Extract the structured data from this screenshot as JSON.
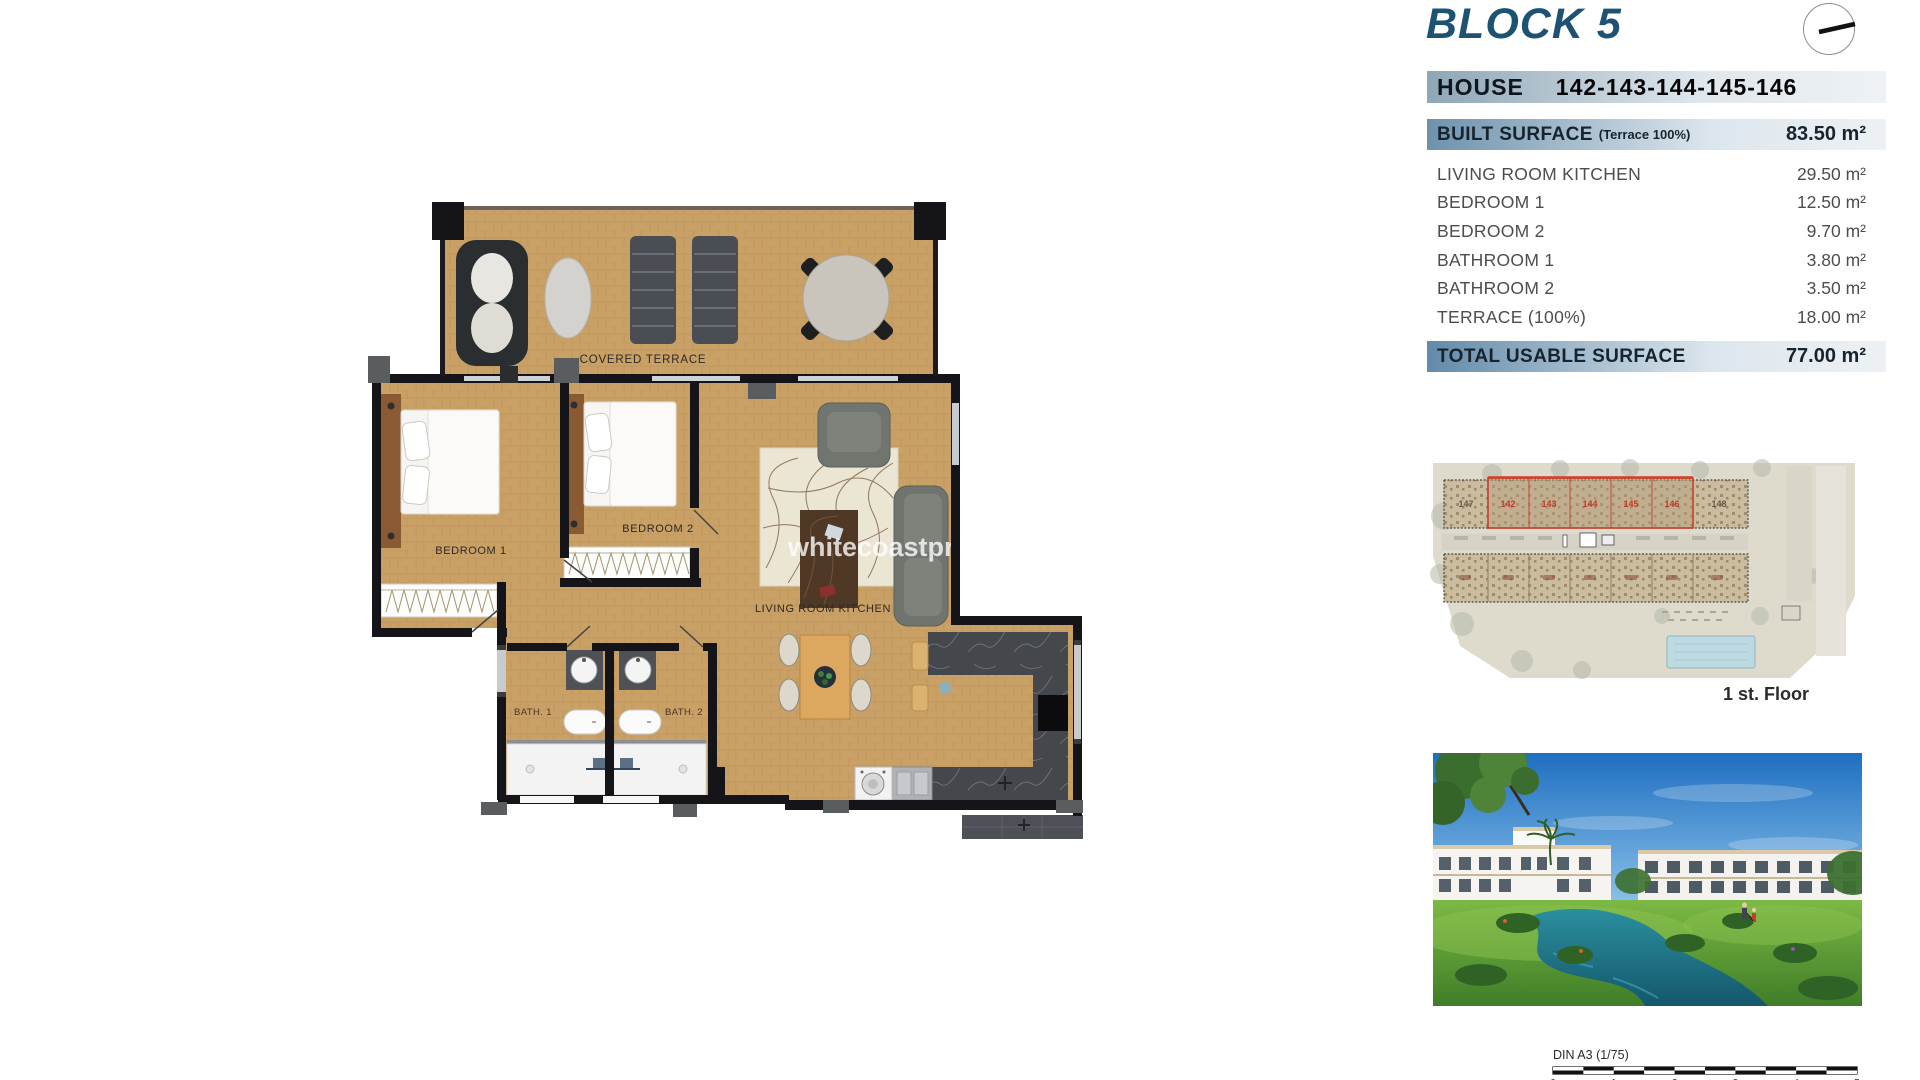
{
  "header": {
    "block_title": "BLOCK 5",
    "house_label": "HOUSE",
    "house_numbers": "142-143-144-145-146"
  },
  "surface_table": {
    "built_label": "BUILT SURFACE",
    "built_note": "(Terrace 100%)",
    "built_value": "83.50 m²",
    "rows": [
      {
        "label": "LIVING ROOM KITCHEN",
        "value": "29.50 m²"
      },
      {
        "label": "BEDROOM 1",
        "value": "12.50 m²"
      },
      {
        "label": "BEDROOM 2",
        "value": "9.70 m²"
      },
      {
        "label": "BATHROOM 1",
        "value": "3.80 m²"
      },
      {
        "label": "BATHROOM 2",
        "value": "3.50 m²"
      },
      {
        "label": "TERRACE (100%)",
        "value": "18.00 m²"
      }
    ],
    "total_label": "TOTAL USABLE SURFACE",
    "total_value": "77.00 m²"
  },
  "floor_plan": {
    "labels": {
      "covered_terrace": "COVERED TERRACE",
      "bedroom_1": "BEDROOM 1",
      "bedroom_2": "BEDROOM 2",
      "living": "LIVING ROOM KITCHEN",
      "bath_1": "BATH. 1",
      "bath_2": "BATH. 2"
    },
    "watermark": "whitecoastpr"
  },
  "site_plan": {
    "floor_label": "1 st. Floor",
    "unit_left": "147",
    "unit_right": "148",
    "highlighted_units": [
      "142",
      "143",
      "144",
      "145",
      "146"
    ],
    "highlight_color": "#c63f2c"
  },
  "scale_bar": {
    "label": "DIN A3 (1/75)",
    "ticks": [
      "0",
      "1",
      "2",
      "3",
      "4",
      "5"
    ]
  },
  "colors": {
    "title_blue": "#1d5273",
    "bar_blue": "#628aa9",
    "wood": "#c9a166",
    "row_text": "#4d4d4f"
  }
}
